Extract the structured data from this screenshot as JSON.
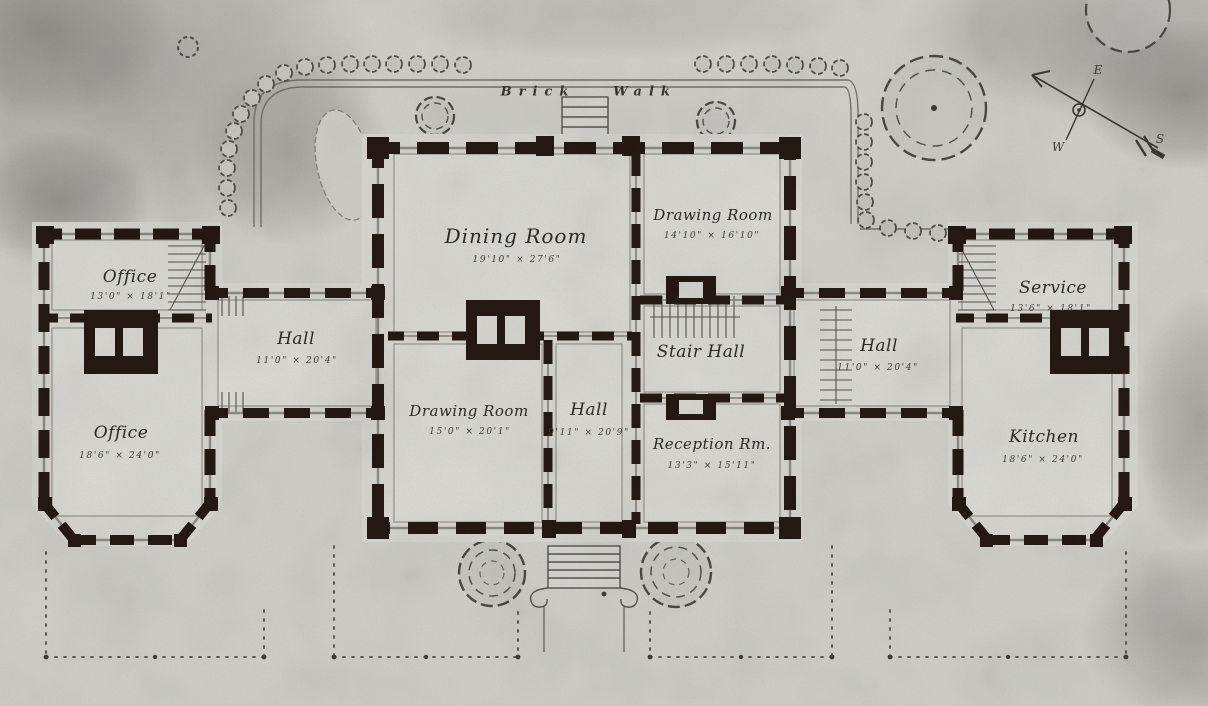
{
  "drawing": {
    "type": "first-floor house plan",
    "paper_color": "#d2d1cb",
    "wall_ink_color": "#251812",
    "line_color": "#6f6e68"
  },
  "walk": {
    "word1": "Brick",
    "word2": "Walk"
  },
  "compass": {
    "east": "E",
    "west": "W",
    "south": "S"
  },
  "rooms": [
    {
      "key": "office-upper-left",
      "name": "Office",
      "dims": "13'0\" × 18'1\""
    },
    {
      "key": "hall-left",
      "name": "Hall",
      "dims": "11'0\" × 20'4\""
    },
    {
      "key": "office-lower-left",
      "name": "Office",
      "dims": "18'6\" × 24'0\""
    },
    {
      "key": "dining-room",
      "name": "Dining Room",
      "dims": "19'10\" × 27'6\""
    },
    {
      "key": "drawing-room-upper",
      "name": "Drawing Room",
      "dims": "14'10\" × 16'10\""
    },
    {
      "key": "stair-hall",
      "name": "Stair Hall",
      "dims": ""
    },
    {
      "key": "drawing-room-lower",
      "name": "Drawing Room",
      "dims": "15'0\" × 20'1\""
    },
    {
      "key": "hall-center",
      "name": "Hall",
      "dims": "9'11\" × 20'9\""
    },
    {
      "key": "reception-room",
      "name": "Reception Rm.",
      "dims": "13'3\" × 15'11\""
    },
    {
      "key": "hall-right",
      "name": "Hall",
      "dims": "11'0\" × 20'4\""
    },
    {
      "key": "service",
      "name": "Service",
      "dims": "13'6\" × 18'1\""
    },
    {
      "key": "kitchen",
      "name": "Kitchen",
      "dims": "18'6\" × 24'0\""
    }
  ]
}
